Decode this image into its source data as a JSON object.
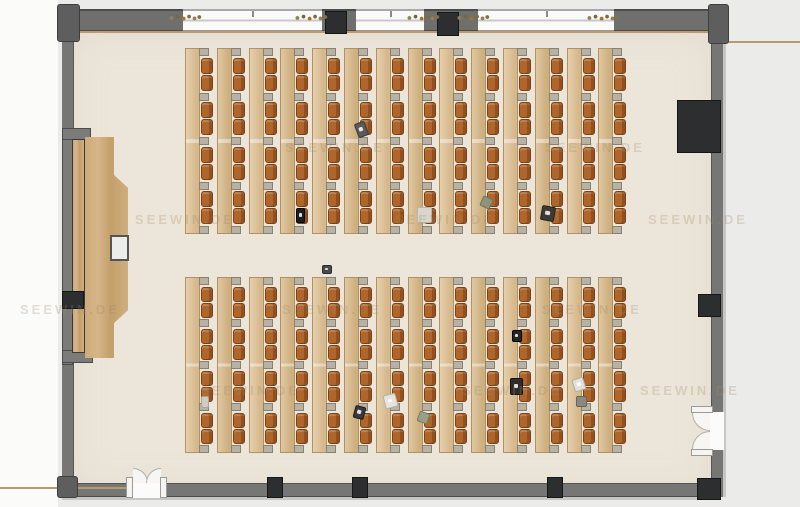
{
  "meta": {
    "watermark_text": "SEEWIN.DE"
  },
  "colors": {
    "floor": "#ece6da",
    "wall": "#767675",
    "outside": "#ebebe9",
    "desk": "#dec092",
    "chair": "#b0662a",
    "wood": "#c9a777",
    "black_fixture": "#2c2e2f",
    "tan_line": "#b89b6d"
  },
  "floor": {
    "x": 66,
    "y": 28,
    "w": 651,
    "h": 466
  },
  "top_wall": {
    "gray_segments": [
      {
        "x": 75,
        "y": 9,
        "w": 108,
        "h": 22
      },
      {
        "x": 322,
        "y": 9,
        "w": 34,
        "h": 22
      },
      {
        "x": 424,
        "y": 9,
        "w": 54,
        "h": 22
      },
      {
        "x": 614,
        "y": 9,
        "w": 101,
        "h": 22
      }
    ],
    "windows": [
      {
        "x": 183,
        "y": 9,
        "w": 139,
        "h": 22
      },
      {
        "x": 356,
        "y": 9,
        "w": 68,
        "h": 22
      },
      {
        "x": 478,
        "y": 9,
        "w": 136,
        "h": 22
      }
    ],
    "ticks": [
      252,
      390,
      546
    ],
    "tan_line": {
      "x": 75,
      "y": 31,
      "w": 638,
      "h": 2
    },
    "boxes": [
      {
        "x": 325,
        "y": 11,
        "w": 22,
        "h": 23
      },
      {
        "x": 437,
        "y": 12,
        "w": 22,
        "h": 24
      }
    ],
    "plants": [
      {
        "x": 168,
        "y": 13,
        "w": 34,
        "h": 9
      },
      {
        "x": 294,
        "y": 13,
        "w": 34,
        "h": 9
      },
      {
        "x": 406,
        "y": 13,
        "w": 34,
        "h": 9
      },
      {
        "x": 456,
        "y": 13,
        "w": 34,
        "h": 9
      },
      {
        "x": 586,
        "y": 13,
        "w": 34,
        "h": 9
      }
    ]
  },
  "bottom_wall": {
    "band": {
      "x": 62,
      "y": 483,
      "w": 655,
      "h": 14
    },
    "outer_line": {
      "x": 62,
      "y": 497,
      "w": 655,
      "h": 3
    },
    "tan_line": {
      "x": 0,
      "y": 487,
      "w": 128,
      "h": 2
    },
    "door": {
      "opening": {
        "x": 133,
        "y": 481,
        "w": 28,
        "h": 17
      },
      "posts": [
        {
          "x": 126,
          "y": 477,
          "w": 7,
          "h": 21
        },
        {
          "x": 160,
          "y": 477,
          "w": 7,
          "h": 21
        }
      ],
      "fans": [
        {
          "x": 133,
          "y": 468,
          "w": 15,
          "h": 15,
          "radius": "0 100% 0 0",
          "border": "top,right"
        },
        {
          "x": 146,
          "y": 468,
          "w": 15,
          "h": 15,
          "radius": "100% 0 0 0",
          "border": "top,left"
        }
      ]
    },
    "pillars": [
      {
        "x": 267,
        "y": 477,
        "w": 16,
        "h": 21
      },
      {
        "x": 352,
        "y": 477,
        "w": 16,
        "h": 21
      },
      {
        "x": 547,
        "y": 477,
        "w": 16,
        "h": 21
      }
    ]
  },
  "right_wall": {
    "band": {
      "x": 711,
      "y": 12,
      "w": 12,
      "h": 485
    },
    "outer_line": {
      "x": 723,
      "y": 12,
      "w": 3,
      "h": 485
    },
    "tan_line": {
      "x": 713,
      "y": 41,
      "w": 87,
      "h": 2
    },
    "big_box": {
      "x": 677,
      "y": 100,
      "w": 44,
      "h": 53
    },
    "pillar": {
      "x": 698,
      "y": 294,
      "w": 23,
      "h": 23
    },
    "corner_block": {
      "x": 697,
      "y": 478,
      "w": 24,
      "h": 22
    },
    "door": {
      "opening": {
        "x": 709,
        "y": 412,
        "w": 15,
        "h": 38
      },
      "posts": [
        {
          "x": 691,
          "y": 406,
          "w": 22,
          "h": 7
        },
        {
          "x": 691,
          "y": 449,
          "w": 22,
          "h": 7
        }
      ],
      "fans": [
        {
          "x": 692,
          "y": 413,
          "w": 18,
          "h": 18,
          "radius": "0 0 0 100%",
          "border": "bottom,left"
        },
        {
          "x": 692,
          "y": 431,
          "w": 18,
          "h": 18,
          "radius": "100% 0 0 0",
          "border": "top,left"
        }
      ]
    }
  },
  "left_wall": {
    "band": {
      "x": 62,
      "y": 36,
      "w": 12,
      "h": 446
    },
    "corner_tl": {
      "x": 57,
      "y": 4,
      "w": 23,
      "h": 38
    },
    "corner_tr": {
      "x": 708,
      "y": 4,
      "w": 21,
      "h": 40
    },
    "corner_bl": {
      "x": 57,
      "y": 476,
      "w": 21,
      "h": 22
    }
  },
  "podium": {
    "niche_bar": {
      "x": 62,
      "y": 128,
      "w": 11,
      "h": 237
    },
    "niche_top": {
      "x": 62,
      "y": 128,
      "w": 29,
      "h": 12
    },
    "niche_bottom": {
      "x": 62,
      "y": 350,
      "w": 31,
      "h": 13
    },
    "rail": {
      "x": 72,
      "y": 139,
      "w": 13,
      "h": 214
    },
    "black_box": {
      "x": 62,
      "y": 291,
      "w": 22,
      "h": 18
    },
    "platform": {
      "x": 85,
      "y": 137,
      "w": 43,
      "h": 221,
      "points": [
        [
          0,
          0
        ],
        [
          29,
          0
        ],
        [
          29,
          38
        ],
        [
          43,
          51
        ],
        [
          43,
          173
        ],
        [
          29,
          186
        ],
        [
          29,
          221
        ],
        [
          0,
          221
        ]
      ]
    },
    "lectern": {
      "x": 110,
      "y": 235,
      "w": 19,
      "h": 26
    }
  },
  "desks": {
    "x0": 185,
    "dx": 31.8,
    "cols": 14,
    "col_w": 28,
    "desk_w": 15,
    "chair_x": 16,
    "chair_w": 12,
    "conn_x": 14,
    "conn_w": 10,
    "conn_h": 8,
    "blocks": [
      {
        "y": 48,
        "h": 186
      },
      {
        "y": 277,
        "h": 176
      }
    ],
    "chairs_per_column": 8
  },
  "floor_objects": [
    {
      "x": 356,
      "y": 122,
      "w": 11,
      "h": 15,
      "rot": -20,
      "bg": "#5a5a58",
      "border": "#3a3a38",
      "dot": true
    },
    {
      "x": 296,
      "y": 208,
      "w": 9,
      "h": 15,
      "rot": 0,
      "bg": "#1d1d1f",
      "border": "#000000",
      "dot": true
    },
    {
      "x": 417,
      "y": 207,
      "w": 15,
      "h": 16,
      "rot": 0,
      "bg": "#d9d6cf",
      "border": "#b9b6af",
      "dot": false
    },
    {
      "x": 481,
      "y": 197,
      "w": 11,
      "h": 11,
      "rot": 25,
      "bg": "#8e9379",
      "border": "#6e735c",
      "dot": false
    },
    {
      "x": 541,
      "y": 206,
      "w": 14,
      "h": 15,
      "rot": 10,
      "bg": "#3c3a35",
      "border": "#222222",
      "dot": true
    },
    {
      "x": 322,
      "y": 265,
      "w": 10,
      "h": 9,
      "rot": 0,
      "bg": "#4a4a4a",
      "border": "#2c2c2c",
      "dot": true
    },
    {
      "x": 201,
      "y": 396,
      "w": 8,
      "h": 12,
      "rot": 0,
      "bg": "#cfccc6",
      "border": "#a8a5a0",
      "dot": false
    },
    {
      "x": 512,
      "y": 330,
      "w": 10,
      "h": 12,
      "rot": 0,
      "bg": "#242424",
      "border": "#000000",
      "dot": true
    },
    {
      "x": 510,
      "y": 378,
      "w": 13,
      "h": 17,
      "rot": 0,
      "bg": "#2e2c28",
      "border": "#111111",
      "dot": true
    },
    {
      "x": 384,
      "y": 394,
      "w": 13,
      "h": 14,
      "rot": -15,
      "bg": "#e6e4de",
      "border": "#b5b3ad",
      "dot": true
    },
    {
      "x": 354,
      "y": 406,
      "w": 11,
      "h": 13,
      "rot": 15,
      "bg": "#3a3a3c",
      "border": "#1a1a1c",
      "dot": true
    },
    {
      "x": 418,
      "y": 412,
      "w": 11,
      "h": 11,
      "rot": 20,
      "bg": "#99a088",
      "border": "#767d66",
      "dot": false
    },
    {
      "x": 573,
      "y": 378,
      "w": 12,
      "h": 13,
      "rot": -18,
      "bg": "#e2e0da",
      "border": "#b0aea8",
      "dot": true
    },
    {
      "x": 576,
      "y": 396,
      "w": 11,
      "h": 11,
      "rot": 0,
      "bg": "#8a8880",
      "border": "#66645c",
      "dot": false
    }
  ],
  "watermarks": [
    {
      "x": 285,
      "y": 140
    },
    {
      "x": 545,
      "y": 140
    },
    {
      "x": 135,
      "y": 212
    },
    {
      "x": 395,
      "y": 212
    },
    {
      "x": 648,
      "y": 212
    },
    {
      "x": 20,
      "y": 302
    },
    {
      "x": 282,
      "y": 302
    },
    {
      "x": 542,
      "y": 302
    },
    {
      "x": 200,
      "y": 383
    },
    {
      "x": 462,
      "y": 383
    },
    {
      "x": 640,
      "y": 383
    }
  ]
}
